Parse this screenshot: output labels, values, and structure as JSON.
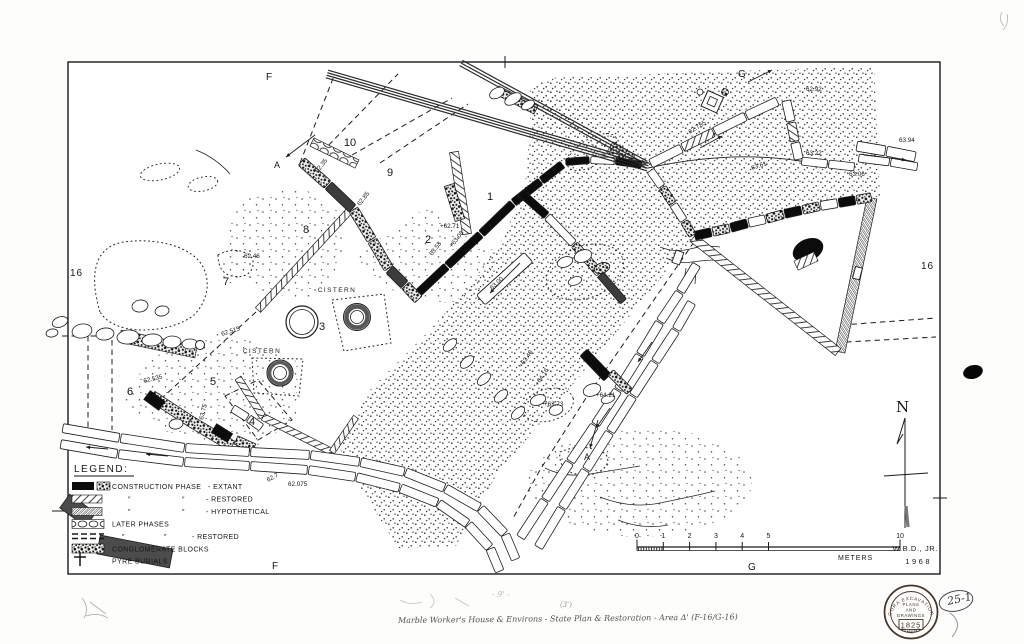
{
  "map": {
    "grid_labels": {
      "top_f": "F",
      "top_g": "G",
      "bottom_f": "F",
      "bottom_g": "G",
      "left_16": "16",
      "right_16": "16"
    },
    "north_label": "N",
    "rooms": [
      {
        "n": "1",
        "x": 490,
        "y": 200
      },
      {
        "n": "2",
        "x": 428,
        "y": 243
      },
      {
        "n": "3",
        "x": 322,
        "y": 330
      },
      {
        "n": "4",
        "x": 252,
        "y": 425
      },
      {
        "n": "5",
        "x": 213,
        "y": 385
      },
      {
        "n": "6",
        "x": 130,
        "y": 395
      },
      {
        "n": "7",
        "x": 226,
        "y": 285
      },
      {
        "n": "8",
        "x": 306,
        "y": 233
      },
      {
        "n": "9",
        "x": 390,
        "y": 176
      },
      {
        "n": "10",
        "x": 350,
        "y": 146
      }
    ],
    "cisterns": [
      {
        "label": "CISTERN",
        "x": 337,
        "y": 292
      },
      {
        "label": "CISTERN",
        "x": 262,
        "y": 353
      }
    ],
    "section_markers": [
      {
        "label": "A",
        "x": 277,
        "y": 168
      },
      {
        "label": "A",
        "x": 587,
        "y": 460
      }
    ],
    "spot_elevations": [
      {
        "t": "62.46",
        "x": 244,
        "y": 258,
        "r": 0
      },
      {
        "t": "62.92",
        "x": 806,
        "y": 91,
        "r": 0
      },
      {
        "t": "63.22",
        "x": 806,
        "y": 155,
        "r": 0
      },
      {
        "t": "63.94",
        "x": 899,
        "y": 142,
        "r": 0
      },
      {
        "t": "63.06",
        "x": 849,
        "y": 176,
        "r": 0
      },
      {
        "t": "62.785",
        "x": 690,
        "y": 134,
        "r": -32
      },
      {
        "t": "63.61",
        "x": 752,
        "y": 170,
        "r": -18
      },
      {
        "t": "62.35",
        "x": 318,
        "y": 173,
        "r": -52
      },
      {
        "t": "62.85",
        "x": 360,
        "y": 206,
        "r": -52
      },
      {
        "t": "+62.71",
        "x": 440,
        "y": 228,
        "r": 0
      },
      {
        "t": "63.53",
        "x": 432,
        "y": 256,
        "r": -52
      },
      {
        "t": "+63.08",
        "x": 452,
        "y": 248,
        "r": -52
      },
      {
        "t": "63.00",
        "x": 492,
        "y": 290,
        "r": -42
      },
      {
        "t": "62.515",
        "x": 222,
        "y": 336,
        "r": -18
      },
      {
        "t": "62.535",
        "x": 144,
        "y": 383,
        "r": -14
      },
      {
        "t": "63.75",
        "x": 203,
        "y": 420,
        "r": -76
      },
      {
        "t": "62.7",
        "x": 268,
        "y": 482,
        "r": -28
      },
      {
        "t": "62.075",
        "x": 288,
        "y": 486,
        "r": 0
      },
      {
        "t": "+63.73",
        "x": 544,
        "y": 406,
        "r": 0
      },
      {
        "t": "+64.21",
        "x": 596,
        "y": 397,
        "r": 0
      },
      {
        "t": "+64.16",
        "x": 538,
        "y": 386,
        "r": -56
      },
      {
        "t": "+63.40",
        "x": 522,
        "y": 368,
        "r": -56
      }
    ]
  },
  "legend": {
    "heading": "LEGEND:",
    "rows": [
      {
        "key": "extant",
        "c1": "CONSTRUCTION PHASE",
        "c2": "",
        "c3": "- EXTANT"
      },
      {
        "key": "restored",
        "c1": "″",
        "c2": "″",
        "c3": "- RESTORED"
      },
      {
        "key": "hypothetical",
        "c1": "″",
        "c2": "″",
        "c3": "- HYPOTHETICAL"
      },
      {
        "key": "later",
        "c1": "LATER  PHASES",
        "c2": "",
        "c3": ""
      },
      {
        "key": "later_restored",
        "c1": "″",
        "c2": "″",
        "c3": "- RESTORED"
      },
      {
        "key": "conglomerate",
        "c1": "CONGLOMERATE  BLOCKS",
        "c2": "",
        "c3": ""
      },
      {
        "key": "pyre",
        "c1": "PYRE  BURIALS",
        "c2": "",
        "c3": ""
      }
    ]
  },
  "scale_bar": {
    "tick_values": [
      0,
      1,
      2,
      3,
      4,
      5,
      10
    ],
    "unit": "METERS"
  },
  "credits": {
    "author": "W.B.D., JR.",
    "year": "1968"
  },
  "stamp": {
    "arc_top": "AGORA EXCAVATIONS",
    "arc_bottom": "ATHENS",
    "line1": "PLANS",
    "line2": "AND",
    "line3": "DRAWINGS",
    "number": "1825"
  },
  "annotations": {
    "page_number": "25-1",
    "caption": "Marble Worker's House & Environs  -  State Plan & Restoration  -  Area Δ' (F-16/G-16)",
    "faint_note": "- 9' -",
    "faint_note2": "(3')"
  }
}
